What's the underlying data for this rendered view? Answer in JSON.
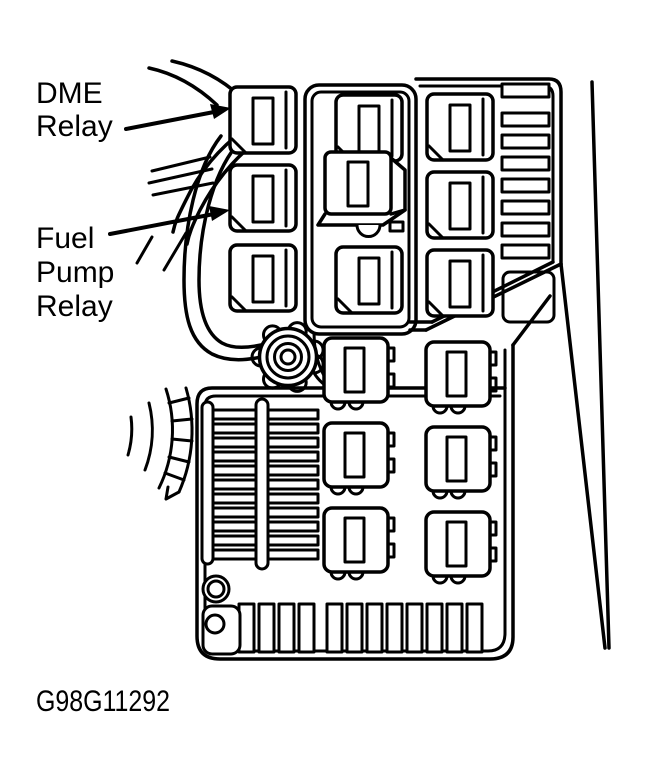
{
  "colors": {
    "background": "#ffffff",
    "ink": "#000000"
  },
  "labels": {
    "dme": {
      "line1": "DME",
      "line2": "Relay"
    },
    "fuel_pump": {
      "line1": "Fuel",
      "line2": "Pump",
      "line3": "Relay"
    }
  },
  "annotations": {
    "dme_arrow_target": "dme-relay",
    "fuel_pump_arrow_target": "fuel-pump-relay"
  },
  "caption": "G98G11292"
}
